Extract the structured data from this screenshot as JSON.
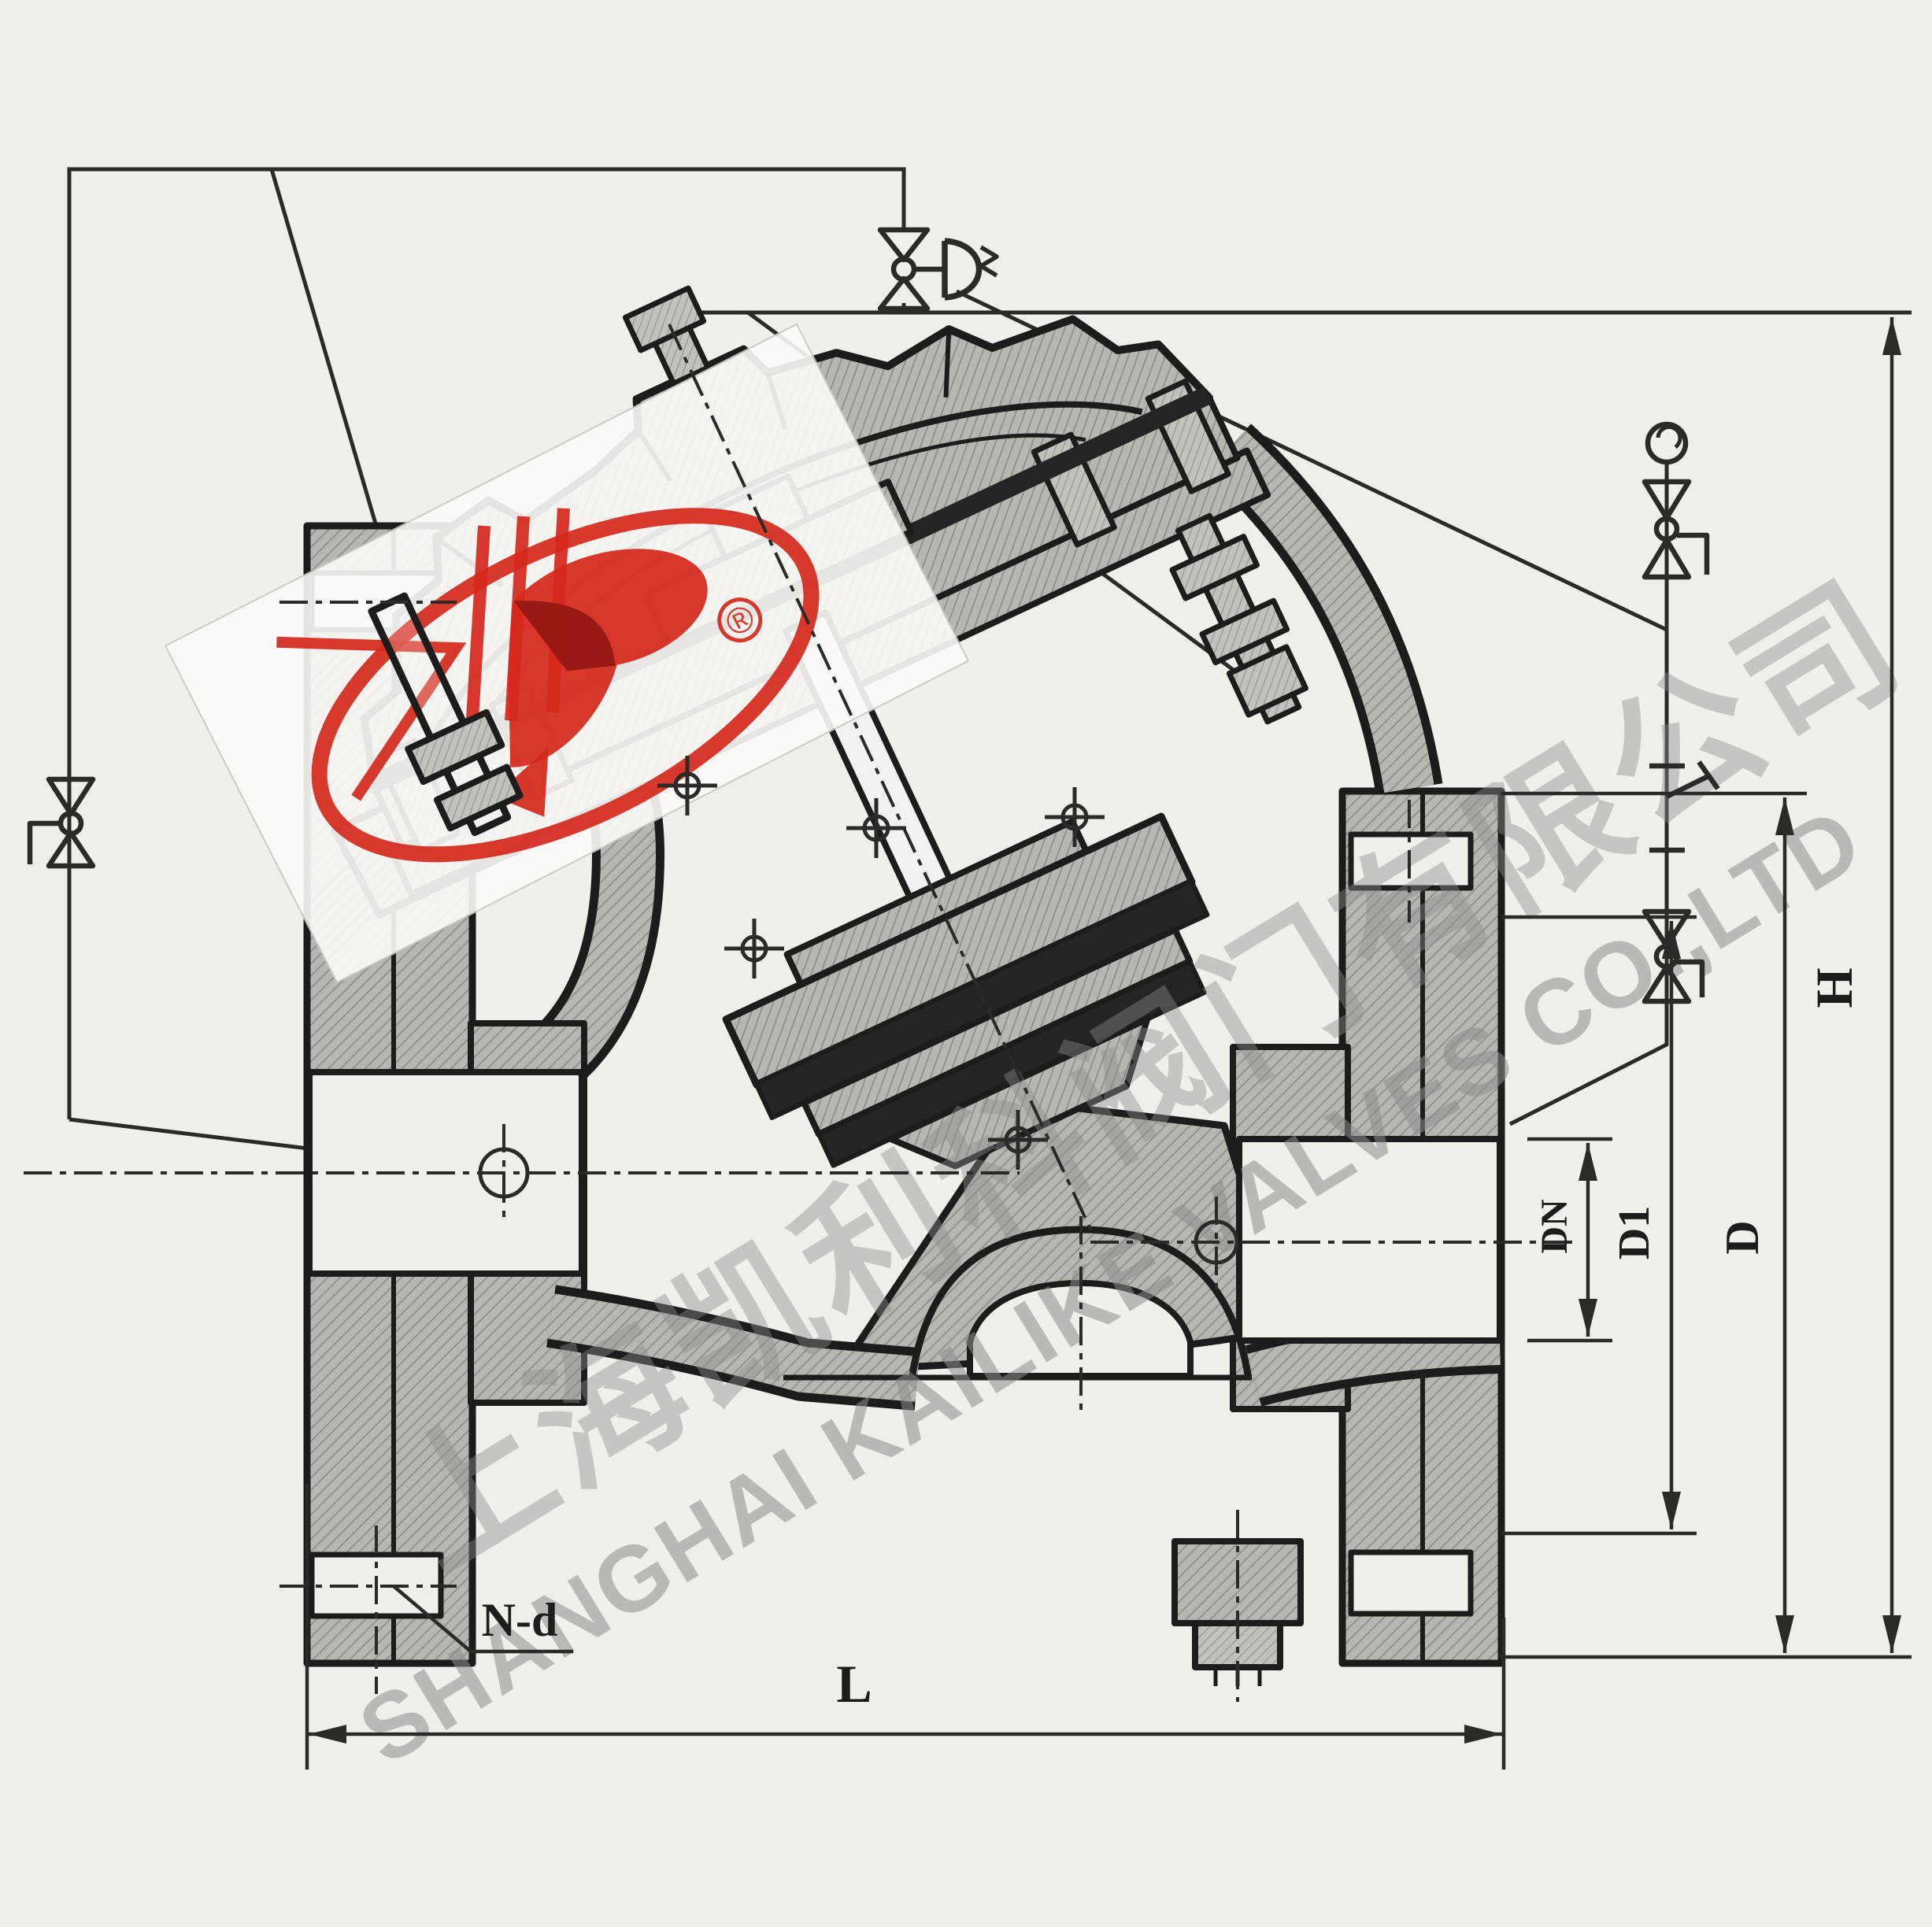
{
  "drawing": {
    "type": "diaphragm pump-control valve cross-section with pilot piping schematic",
    "dimension_labels": {
      "height": "H",
      "face_to_face": "L",
      "flange_od": "D",
      "bolt_circle": "D1",
      "nominal_bore": "DN",
      "bolt_holes": "N-d"
    },
    "watermark": {
      "company_cn": "上海凯利科阀门有限公司",
      "company_en": "SHANGHAI KAILIKE VALVES CO.,LTD",
      "registered": "®"
    },
    "colors": {
      "paper": "#f1efe9",
      "line": "#1d1c1a",
      "metal_gray": "#b8b6b0",
      "seal_dark": "#242424",
      "watermark_gray": "#8d8d8d",
      "logo_red": "#d5281c"
    }
  }
}
